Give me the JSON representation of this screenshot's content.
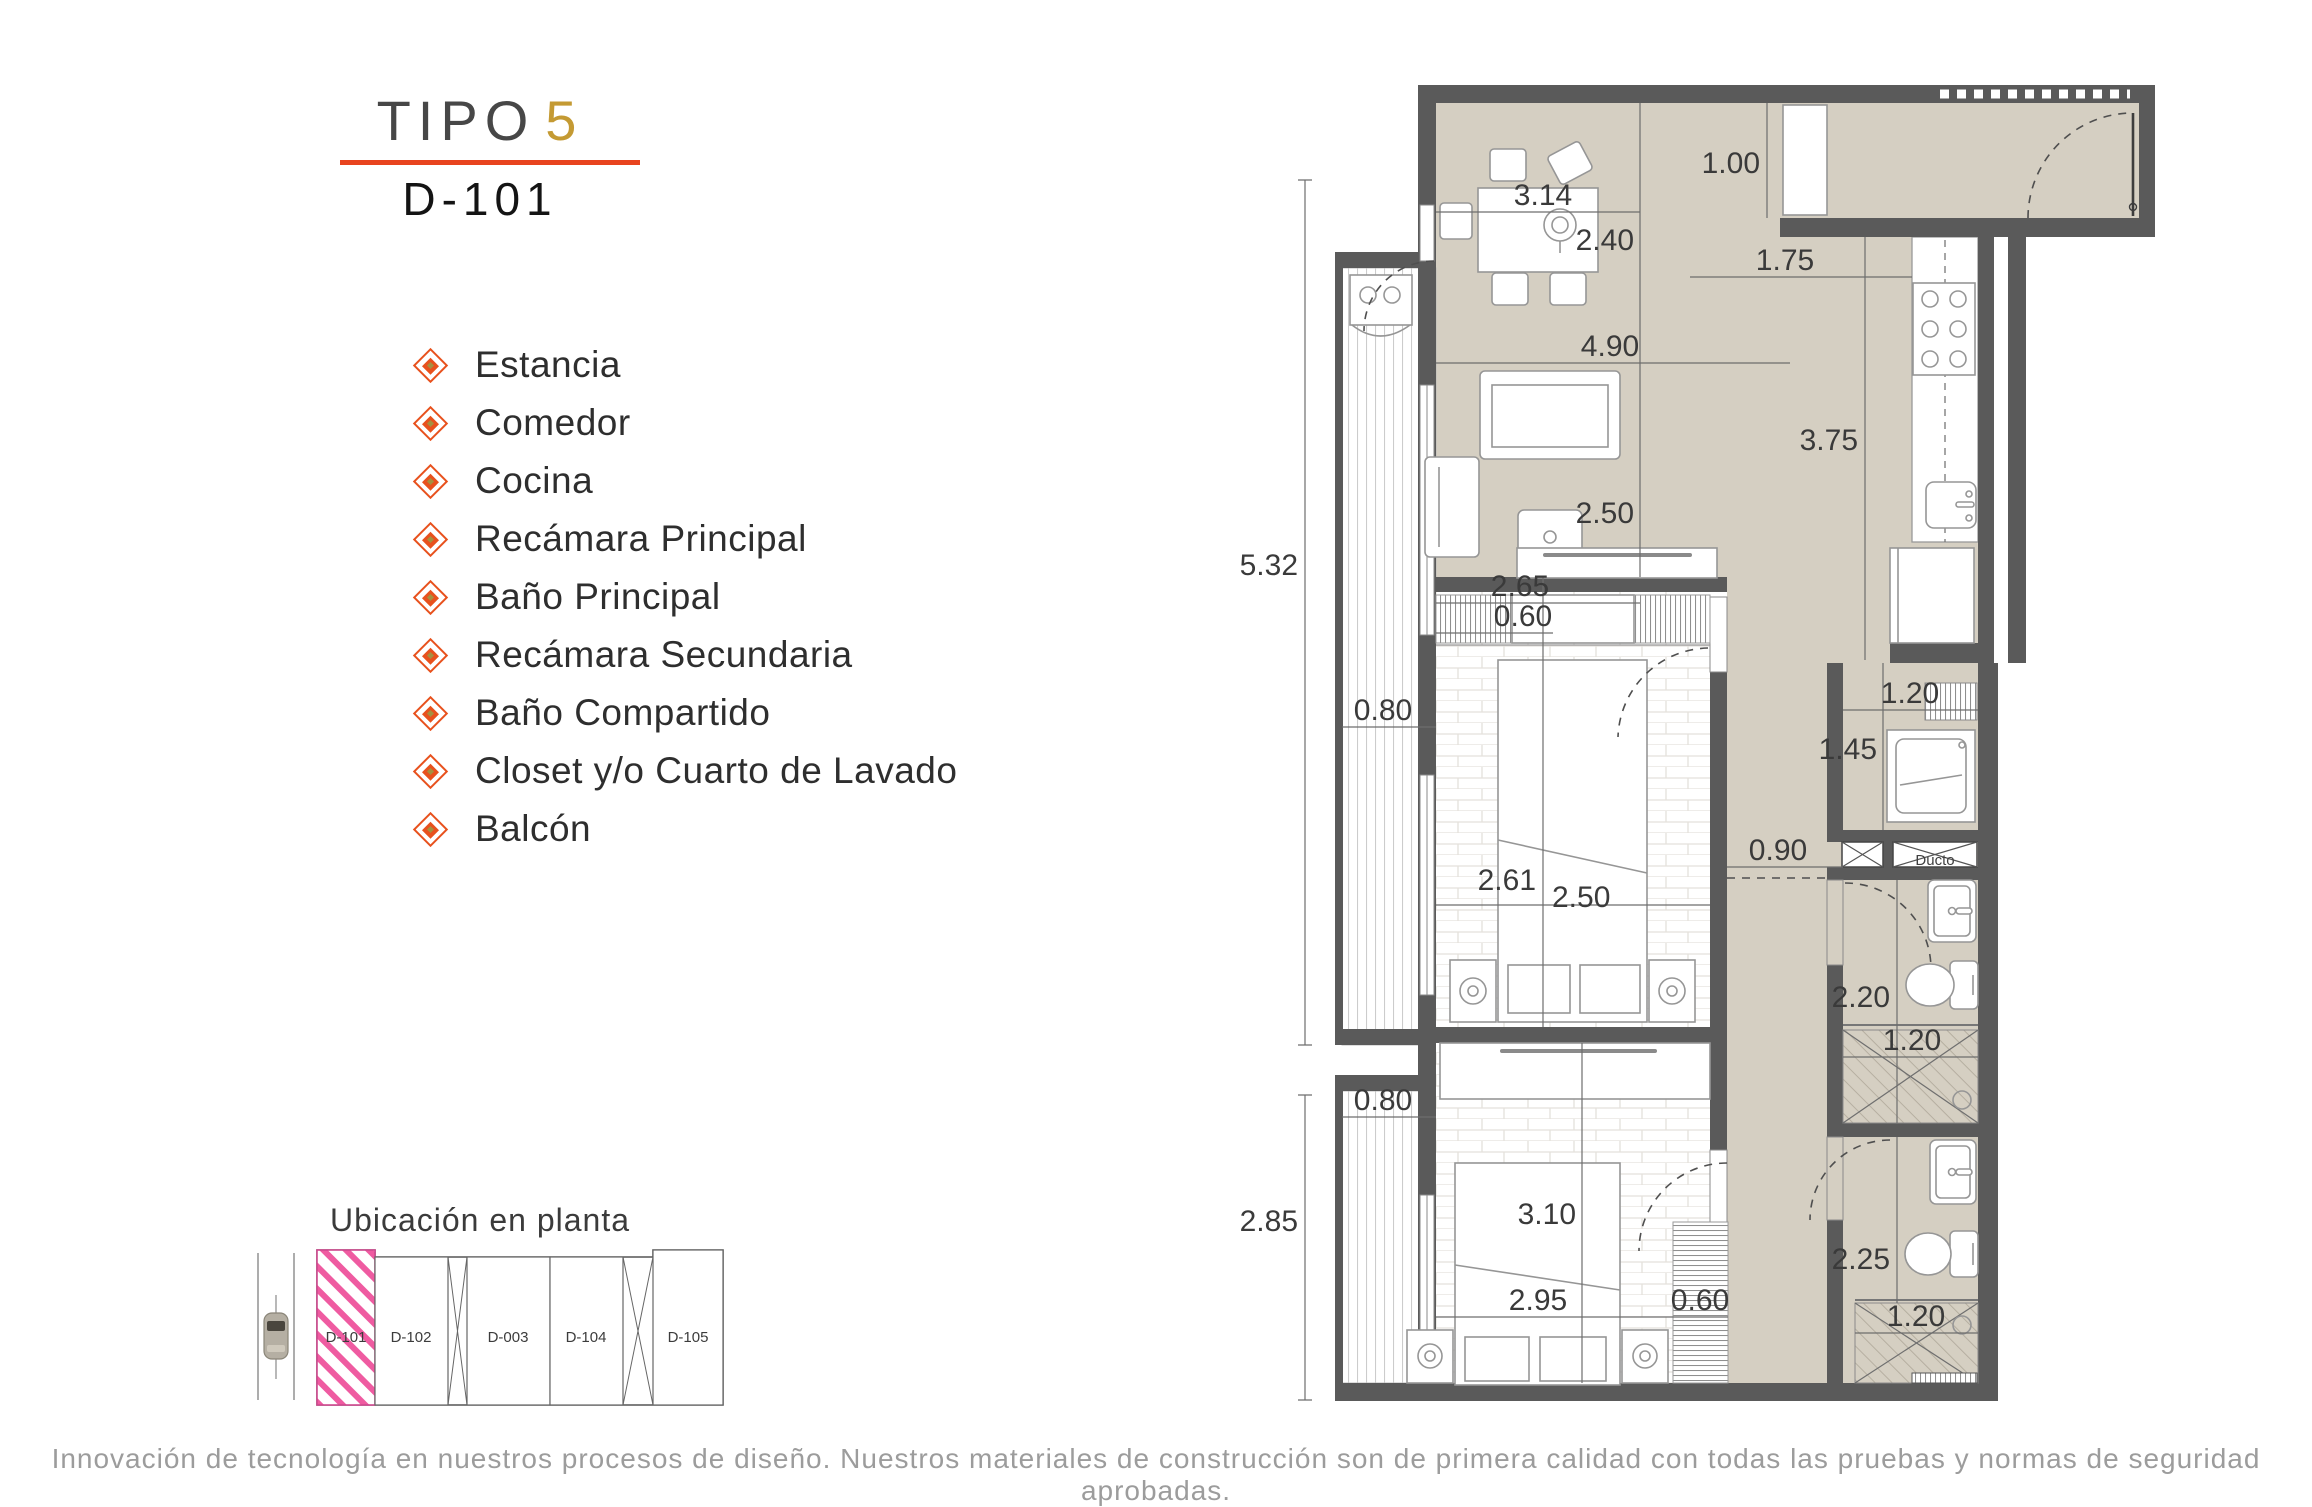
{
  "header": {
    "tipo": "TIPO",
    "number": "5",
    "unit": "D-101"
  },
  "rooms": [
    "Estancia",
    "Comedor",
    "Cocina",
    "Recámara Principal",
    "Baño Principal",
    "Recámara Secundaria",
    "Baño Compartido",
    "Closet y/o Cuarto de Lavado",
    "Balcón"
  ],
  "plan": {
    "labels": {
      "ducto": "Ducto"
    },
    "dimensions": [
      {
        "area": "acceso",
        "v": "1.00"
      },
      {
        "area": "comedor",
        "v": "3.14"
      },
      {
        "area": "comedor",
        "v": "2.40"
      },
      {
        "area": "cocina",
        "v": "1.75"
      },
      {
        "area": "estancia",
        "v": "4.90"
      },
      {
        "area": "cocina",
        "v": "3.75"
      },
      {
        "area": "estancia",
        "v": "2.50"
      },
      {
        "area": "estancia",
        "v": "2.65"
      },
      {
        "area": "exterior-izquierda",
        "v": "5.32"
      },
      {
        "area": "closet-recamara-principal",
        "v": "0.60"
      },
      {
        "area": "balcon-superior",
        "v": "0.80"
      },
      {
        "area": "recamara-principal",
        "v": "2.61"
      },
      {
        "area": "recamara-principal",
        "v": "2.50"
      },
      {
        "area": "pasillo",
        "v": "0.90"
      },
      {
        "area": "cuarto-de-lavado",
        "v": "1.20"
      },
      {
        "area": "cuarto-de-lavado",
        "v": "1.45"
      },
      {
        "area": "bano-principal",
        "v": "2.20"
      },
      {
        "area": "bano-principal-regadera",
        "v": "1.20"
      },
      {
        "area": "balcon-inferior",
        "v": "0.80"
      },
      {
        "area": "exterior-izquierda-inferior",
        "v": "2.85"
      },
      {
        "area": "recamara-secundaria",
        "v": "3.10"
      },
      {
        "area": "recamara-secundaria",
        "v": "2.95"
      },
      {
        "area": "closet-recamara-secundaria",
        "v": "0.60"
      },
      {
        "area": "bano-compartido",
        "v": "2.25"
      },
      {
        "area": "bano-compartido-regadera",
        "v": "1.20"
      }
    ]
  },
  "location": {
    "title": "Ubicación en planta",
    "units": [
      "D-101",
      "D-102",
      "D-003",
      "D-104",
      "D-105"
    ],
    "highlighted": "D-101"
  },
  "footer": {
    "text": "Innovación de tecnología en nuestros procesos de diseño. Nuestros materiales de construcción son de primera calidad con todas las pruebas y normas de seguridad aprobadas."
  },
  "colors": {
    "accent_red": "#e8441f",
    "accent_gold": "#c49a33",
    "bullet_orange": "#e8511d",
    "bullet_core_olive": "#a59040",
    "wall_gray": "#5a5a5a",
    "floor_beige": "#d5cfc2",
    "highlight_pink": "#ef5ba1",
    "footer_gray": "#9c9c9c"
  }
}
